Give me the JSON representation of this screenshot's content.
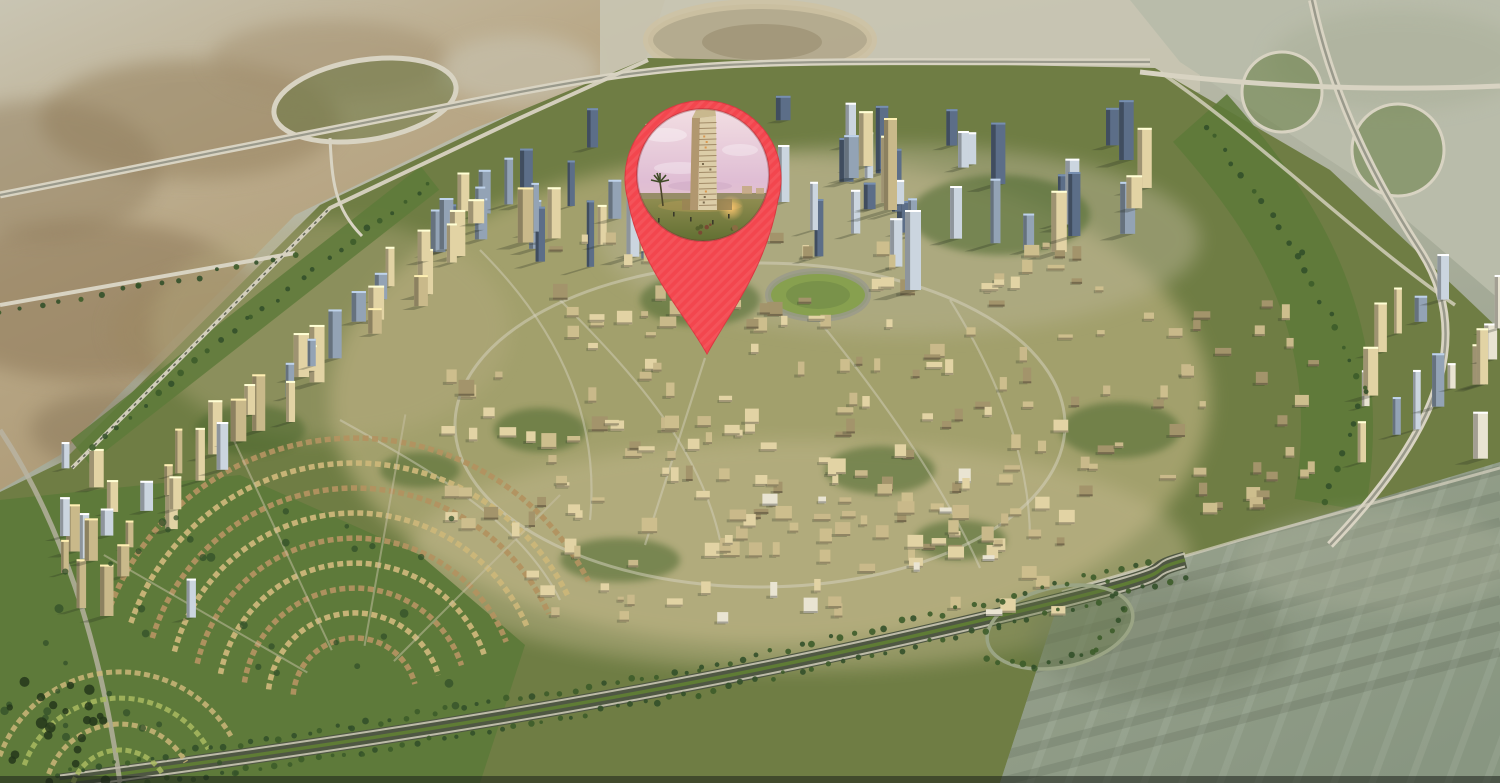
{
  "scene": {
    "label": "Aerial 3D render of a circular master-planned desert city district with perimeter highways, interchanges, villa crescents and tower clusters, marked with a red location pin"
  },
  "pin": {
    "icon": "location-pin-icon",
    "inset": "tower-building-photo",
    "red": "#F3464E",
    "red_dark": "#D93840"
  },
  "palette": {
    "base_top": "#C6C4B4",
    "base_bottom": "#8F9A85",
    "desert_tan": "#B9A887",
    "desert_tan_dark": "#96825E",
    "desert_pale": "#C9C5B3",
    "desert_gray": "#9AA38E",
    "desert_gray_dark": "#7E8A72",
    "community_green": "#6F7D44",
    "green_dark": "#4C682E",
    "green_belt": "#5E7A3A",
    "green_light": "#87A04F",
    "urban_beige": "#CDBE8D",
    "road_light": "#D8D3C2",
    "road_dark": "#4F5743",
    "road_mid": "#9A9A8C",
    "tower_blue": "#5C6E88",
    "tower_blue_light": "#93A3B5",
    "tower_glass": "#CBD5DF",
    "bld_cream": "#E2D3A4",
    "bld_tan": "#C9B98A",
    "bld_dark": "#A3946B",
    "bld_white": "#E9E4D2",
    "shadow": "#2A3124",
    "tree": "#33502A",
    "photo_sky_top": "#F2DEE2",
    "photo_sky_mid": "#DFBDD4",
    "photo_sky_low": "#EACCC2",
    "photo_tower": "#DCCDA8",
    "photo_tower_shade": "#B1976F",
    "photo_lawn_top": "#8F8C50",
    "photo_lawn_bot": "#5F6E31",
    "photo_glow": "#FFC76E",
    "photo_palm": "#3E4A26"
  }
}
